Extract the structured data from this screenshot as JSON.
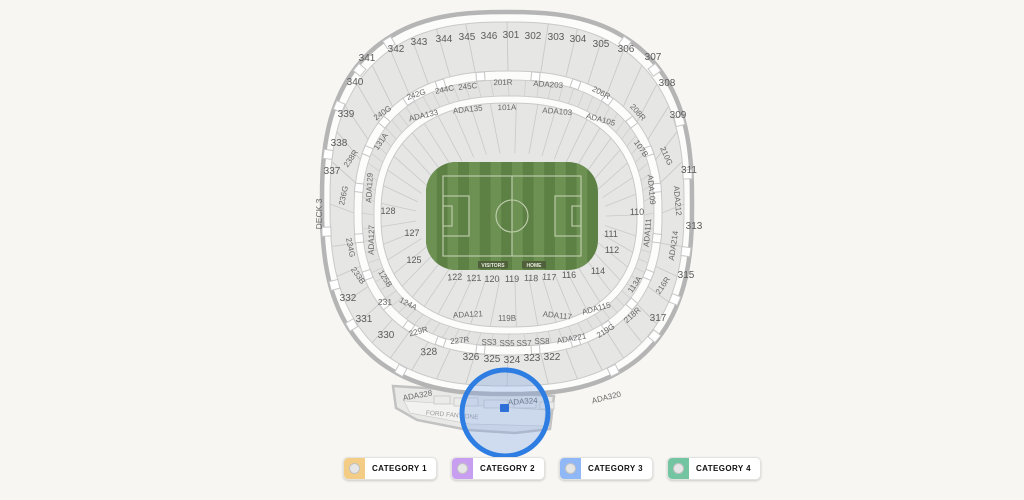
{
  "app": {
    "background": "#f7f6f3"
  },
  "map": {
    "colors": {
      "promenade": "#fcfcfb",
      "wall": "#b5b5b5",
      "section_fill": "#e6e6e5",
      "section_fill_alt": "#e3e3e2",
      "section_line": "#c9c9c9",
      "tick_line": "#cccccc",
      "tab_fill": "#e9e9e8",
      "tab_line": "#c2c2c2",
      "tab_inner": "#f2f2f1",
      "gate_fill": "#ffffff",
      "gate_line": "#c6c6c6",
      "field_dark": "#5d8044",
      "field_light": "#6c9153",
      "field_line": "#c3cfb0",
      "bench_bg": "#4e5f39",
      "bench_text": "#e8ecdf",
      "label": "#5b5b5b",
      "label_small": "#686868",
      "label_faint": "#9b9b9b"
    },
    "field": {
      "visitors_label": "VISITORS",
      "home_label": "HOME"
    },
    "labels": [
      {
        "t": "341",
        "x": 367,
        "y": 61,
        "r": 0,
        "f": 10
      },
      {
        "t": "342",
        "x": 396,
        "y": 52,
        "r": 0,
        "f": 10
      },
      {
        "t": "343",
        "x": 419,
        "y": 45,
        "r": 0,
        "f": 10
      },
      {
        "t": "344",
        "x": 444,
        "y": 42,
        "r": 0,
        "f": 10
      },
      {
        "t": "345",
        "x": 467,
        "y": 40,
        "r": 0,
        "f": 10
      },
      {
        "t": "346",
        "x": 489,
        "y": 39,
        "r": 0,
        "f": 10
      },
      {
        "t": "301",
        "x": 511,
        "y": 38,
        "r": 0,
        "f": 10
      },
      {
        "t": "302",
        "x": 533,
        "y": 39,
        "r": 0,
        "f": 10
      },
      {
        "t": "303",
        "x": 556,
        "y": 40,
        "r": 0,
        "f": 10
      },
      {
        "t": "304",
        "x": 578,
        "y": 42,
        "r": 0,
        "f": 10
      },
      {
        "t": "305",
        "x": 601,
        "y": 47,
        "r": 0,
        "f": 10
      },
      {
        "t": "306",
        "x": 626,
        "y": 52,
        "r": 0,
        "f": 10
      },
      {
        "t": "307",
        "x": 653,
        "y": 60,
        "r": 0,
        "f": 10
      },
      {
        "t": "340",
        "x": 355,
        "y": 85,
        "r": 0,
        "f": 10
      },
      {
        "t": "308",
        "x": 667,
        "y": 86,
        "r": 0,
        "f": 10
      },
      {
        "t": "339",
        "x": 346,
        "y": 117,
        "r": 0,
        "f": 10
      },
      {
        "t": "309",
        "x": 678,
        "y": 118,
        "r": 0,
        "f": 10
      },
      {
        "t": "338",
        "x": 339,
        "y": 146,
        "r": 0,
        "f": 10
      },
      {
        "t": "337",
        "x": 332,
        "y": 174,
        "r": 0,
        "f": 10
      },
      {
        "t": "311",
        "x": 689,
        "y": 173,
        "r": 0,
        "f": 10
      },
      {
        "t": "313",
        "x": 694,
        "y": 229,
        "r": 0,
        "f": 10
      },
      {
        "t": "315",
        "x": 686,
        "y": 278,
        "r": 0,
        "f": 10
      },
      {
        "t": "317",
        "x": 658,
        "y": 321,
        "r": 0,
        "f": 10
      },
      {
        "t": "332",
        "x": 348,
        "y": 301,
        "r": 0,
        "f": 10
      },
      {
        "t": "331",
        "x": 364,
        "y": 322,
        "r": 0,
        "f": 10
      },
      {
        "t": "330",
        "x": 386,
        "y": 338,
        "r": 0,
        "f": 10
      },
      {
        "t": "328",
        "x": 429,
        "y": 355,
        "r": -3,
        "f": 10
      },
      {
        "t": "326",
        "x": 471,
        "y": 360,
        "r": 0,
        "f": 10
      },
      {
        "t": "325",
        "x": 492,
        "y": 362,
        "r": 0,
        "f": 10
      },
      {
        "t": "324",
        "x": 512,
        "y": 363,
        "r": 0,
        "f": 10
      },
      {
        "t": "323",
        "x": 532,
        "y": 361,
        "r": 0,
        "f": 10
      },
      {
        "t": "322",
        "x": 552,
        "y": 360,
        "r": 0,
        "f": 10
      },
      {
        "t": "DECK 3",
        "x": 322,
        "y": 214,
        "r": -90,
        "f": 8.5
      },
      {
        "t": "242G",
        "x": 417,
        "y": 97,
        "r": -18,
        "f": 8
      },
      {
        "t": "244C",
        "x": 445,
        "y": 92,
        "r": -11,
        "f": 8
      },
      {
        "t": "245C",
        "x": 468,
        "y": 89,
        "r": -6,
        "f": 8
      },
      {
        "t": "201R",
        "x": 503,
        "y": 85,
        "r": -1,
        "f": 8
      },
      {
        "t": "ADA203",
        "x": 548,
        "y": 87,
        "r": 4,
        "f": 8
      },
      {
        "t": "206R",
        "x": 600,
        "y": 95,
        "r": 27,
        "f": 8
      },
      {
        "t": "208R",
        "x": 636,
        "y": 114,
        "r": 48,
        "f": 8
      },
      {
        "t": "210G",
        "x": 664,
        "y": 157,
        "r": 66,
        "f": 8
      },
      {
        "t": "ADA212",
        "x": 675,
        "y": 201,
        "r": 85,
        "f": 8
      },
      {
        "t": "ADA214",
        "x": 676,
        "y": 246,
        "r": -82,
        "f": 8
      },
      {
        "t": "216R",
        "x": 665,
        "y": 287,
        "r": -56,
        "f": 8
      },
      {
        "t": "218R",
        "x": 634,
        "y": 317,
        "r": -42,
        "f": 8
      },
      {
        "t": "219G",
        "x": 607,
        "y": 333,
        "r": -32,
        "f": 8
      },
      {
        "t": "ADA221",
        "x": 572,
        "y": 341,
        "r": -10,
        "f": 8
      },
      {
        "t": "SS8",
        "x": 542,
        "y": 344,
        "r": 0,
        "f": 8
      },
      {
        "t": "SS7",
        "x": 524,
        "y": 346,
        "r": 0,
        "f": 8
      },
      {
        "t": "SS5",
        "x": 507,
        "y": 346,
        "r": 0,
        "f": 8
      },
      {
        "t": "SS3",
        "x": 489,
        "y": 345,
        "r": 0,
        "f": 8
      },
      {
        "t": "227R",
        "x": 460,
        "y": 343,
        "r": -6,
        "f": 8
      },
      {
        "t": "229R",
        "x": 419,
        "y": 334,
        "r": -15,
        "f": 8
      },
      {
        "t": "231",
        "x": 385,
        "y": 305,
        "r": 0,
        "f": 8.5
      },
      {
        "t": "233B",
        "x": 356,
        "y": 277,
        "r": 55,
        "f": 8
      },
      {
        "t": "234G",
        "x": 348,
        "y": 248,
        "r": 78,
        "f": 8
      },
      {
        "t": "236G",
        "x": 346,
        "y": 196,
        "r": -78,
        "f": 8
      },
      {
        "t": "238R",
        "x": 353,
        "y": 160,
        "r": -56,
        "f": 8
      },
      {
        "t": "240G",
        "x": 384,
        "y": 115,
        "r": -35,
        "f": 8
      },
      {
        "t": "ADA133",
        "x": 424,
        "y": 118,
        "r": -13,
        "f": 8
      },
      {
        "t": "ADA135",
        "x": 468,
        "y": 112,
        "r": -6,
        "f": 8
      },
      {
        "t": "101A",
        "x": 507,
        "y": 110,
        "r": -1,
        "f": 8
      },
      {
        "t": "ADA103",
        "x": 557,
        "y": 114,
        "r": 5,
        "f": 8
      },
      {
        "t": "ADA105",
        "x": 600,
        "y": 122,
        "r": 15,
        "f": 8
      },
      {
        "t": "107B",
        "x": 639,
        "y": 150,
        "r": 55,
        "f": 8
      },
      {
        "t": "ADA109",
        "x": 649,
        "y": 190,
        "r": 85,
        "f": 8
      },
      {
        "t": "131A",
        "x": 383,
        "y": 143,
        "r": -55,
        "f": 8
      },
      {
        "t": "ADA129",
        "x": 372,
        "y": 188,
        "r": -87,
        "f": 8
      },
      {
        "t": "ADA127",
        "x": 374,
        "y": 240,
        "r": -89,
        "f": 8
      },
      {
        "t": "125B",
        "x": 383,
        "y": 280,
        "r": 58,
        "f": 8
      },
      {
        "t": "124A",
        "x": 407,
        "y": 306,
        "r": 28,
        "f": 8
      },
      {
        "t": "128",
        "x": 388,
        "y": 214,
        "r": 0,
        "f": 9
      },
      {
        "t": "127",
        "x": 412,
        "y": 236,
        "r": 0,
        "f": 9
      },
      {
        "t": "125",
        "x": 414,
        "y": 263,
        "r": 0,
        "f": 9
      },
      {
        "t": "122",
        "x": 455,
        "y": 280,
        "r": -4,
        "f": 9
      },
      {
        "t": "121",
        "x": 474,
        "y": 281,
        "r": -2,
        "f": 9
      },
      {
        "t": "120",
        "x": 492,
        "y": 282,
        "r": 0,
        "f": 9
      },
      {
        "t": "119",
        "x": 512,
        "y": 282,
        "r": 0,
        "f": 9
      },
      {
        "t": "118",
        "x": 531,
        "y": 281,
        "r": 2,
        "f": 9
      },
      {
        "t": "117",
        "x": 549,
        "y": 280,
        "r": 4,
        "f": 9
      },
      {
        "t": "116",
        "x": 569,
        "y": 278,
        "r": 0,
        "f": 9
      },
      {
        "t": "114",
        "x": 598,
        "y": 274,
        "r": 0,
        "f": 9
      },
      {
        "t": "113A",
        "x": 637,
        "y": 286,
        "r": -55,
        "f": 8
      },
      {
        "t": "110",
        "x": 637,
        "y": 215,
        "r": 0,
        "f": 9
      },
      {
        "t": "111",
        "x": 611,
        "y": 237,
        "r": 0,
        "f": 9
      },
      {
        "t": "112",
        "x": 612,
        "y": 253,
        "r": 0,
        "f": 9
      },
      {
        "t": "ADA111",
        "x": 650,
        "y": 233,
        "r": -85,
        "f": 8
      },
      {
        "t": "ADA121",
        "x": 468,
        "y": 317,
        "r": -3,
        "f": 8
      },
      {
        "t": "119B",
        "x": 507,
        "y": 321,
        "r": 0,
        "f": 8
      },
      {
        "t": "ADA117",
        "x": 557,
        "y": 318,
        "r": 6,
        "f": 8
      },
      {
        "t": "ADA115",
        "x": 597,
        "y": 311,
        "r": -15,
        "f": 8
      },
      {
        "t": "ADA328",
        "x": 418,
        "y": 398,
        "r": -10,
        "f": 8
      },
      {
        "t": "ADA324",
        "x": 523,
        "y": 404,
        "r": -4,
        "f": 8
      },
      {
        "t": "ADA320",
        "x": 607,
        "y": 400,
        "r": -14,
        "f": 8
      },
      {
        "t": "FORD FAN ZONE",
        "x": 452,
        "y": 417,
        "r": 5,
        "f": 6.5,
        "c": "#9b9b9b",
        "ni": true
      }
    ]
  },
  "selection": {
    "cx": 505,
    "cy": 413,
    "radius": 43,
    "border_color": "#2e7de2",
    "fill": "rgba(125,165,230,0.32)",
    "marker": {
      "x": 500,
      "y": 404,
      "w": 9,
      "h": 8,
      "color": "#2b6fd7"
    }
  },
  "legend": {
    "items": [
      {
        "label": "CATEGORY 1",
        "color": "#f3cd86"
      },
      {
        "label": "CATEGORY 2",
        "color": "#c89ef0"
      },
      {
        "label": "CATEGORY 3",
        "color": "#90b8f6"
      },
      {
        "label": "CATEGORY 4",
        "color": "#72c5a0"
      }
    ]
  }
}
